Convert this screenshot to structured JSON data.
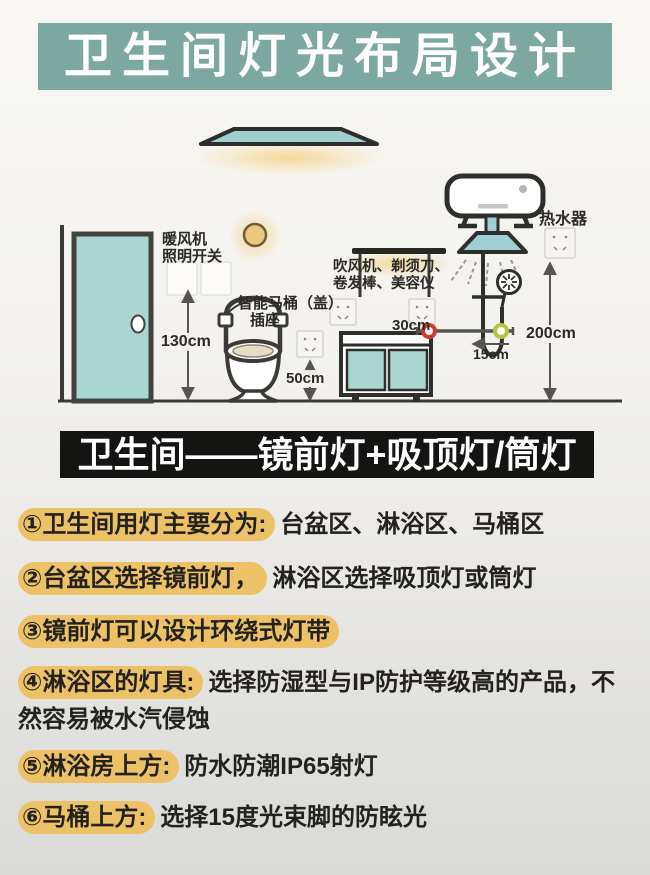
{
  "title": "卫生间灯光布局设计",
  "subtitle": "卫生间——镜前灯+吸顶灯/筒灯",
  "diagram": {
    "heater_switch_label": {
      "line1": "暖风机",
      "line2": "照明开关"
    },
    "toilet_label": {
      "line1": "智能马桶（盖）",
      "line2": "插座"
    },
    "appliance_label": {
      "line1": "吹风机、剃须刀、",
      "line2": "卷发棒、美容仪"
    },
    "water_heater_label": "热水器",
    "dimensions": {
      "switch_height": "130cm",
      "toilet_socket_height": "50cm",
      "mirror_socket_gap": "30cm",
      "heater_socket_height": "200cm",
      "shower_offset": "15cm"
    }
  },
  "list_items": [
    {
      "highlight": "①卫生间用灯主要分为:",
      "rest": "台盆区、淋浴区、马桶区"
    },
    {
      "highlight": "②台盆区选择镜前灯，",
      "rest": "淋浴区选择吸顶灯或筒灯"
    },
    {
      "highlight": "③镜前灯可以设计环绕式灯带",
      "rest": ""
    },
    {
      "highlight": "④淋浴区的灯具:",
      "rest": "选择防湿型与IP防护等级高的产品，不然容易被水汽侵蚀"
    },
    {
      "highlight": "⑤淋浴房上方:",
      "rest": "防水防潮IP65射灯"
    },
    {
      "highlight": "⑥马桶上方:",
      "rest": "选择15度光束脚的防眩光"
    }
  ],
  "colors": {
    "accent_teal": "#7da8a2",
    "fixture_teal": "#a9d6d1",
    "highlight_yellow": "#edc166",
    "subtitle_bg": "#141412"
  }
}
